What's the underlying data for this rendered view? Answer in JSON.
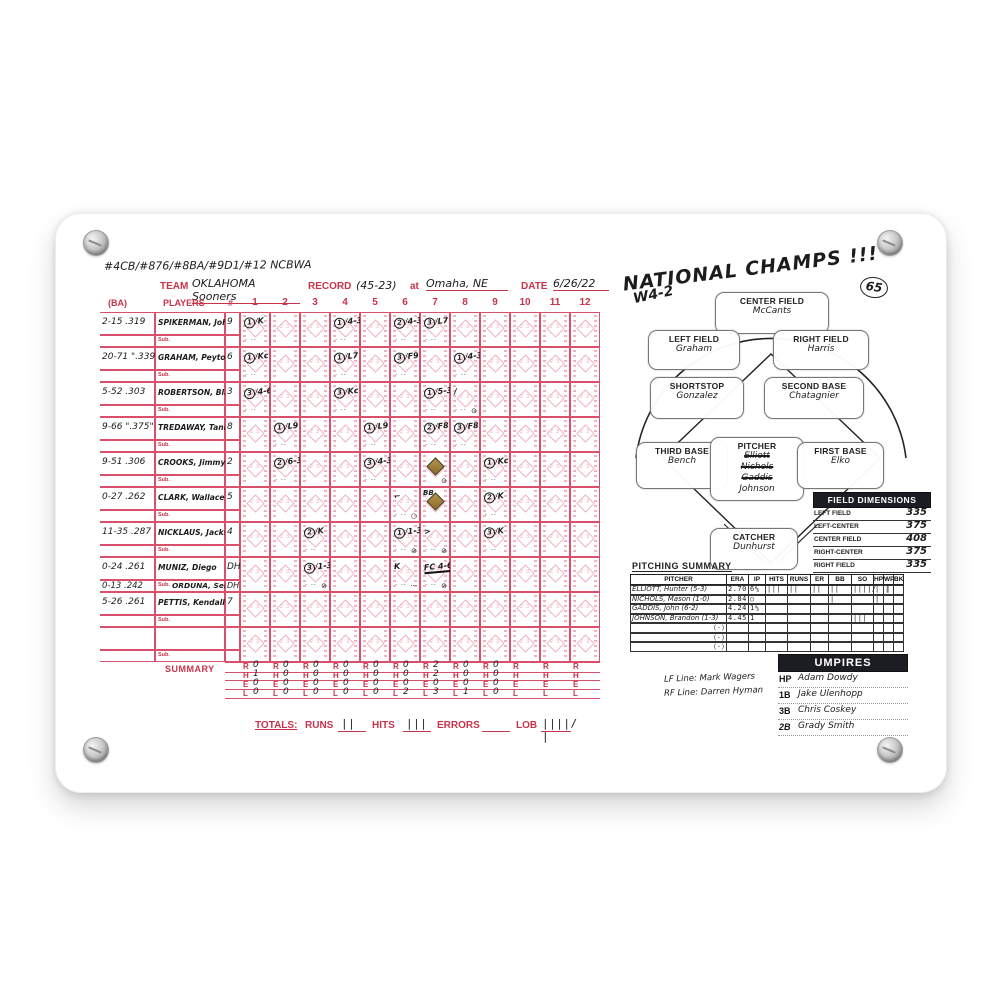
{
  "plaque": {
    "description": "white mounted scorecard plaque"
  },
  "scorecard": {
    "rankings_note": "#4CB/#876/#8BA/#9D1/#12 NCBWA",
    "header": {
      "team_label": "TEAM",
      "team": "OKLAHOMA Sooners",
      "record_label": "RECORD",
      "record": "(45-23)",
      "at_label": "at",
      "location": "Omaha, NE",
      "date_label": "DATE",
      "date": "6/26/22"
    },
    "grid": {
      "ba_label": "(BA)",
      "players_label": "PLAYERS",
      "pos_label": "#",
      "sub_label": "Sub.",
      "summary_label": "SUMMARY",
      "innings": [
        "1",
        "2",
        "3",
        "4",
        "5",
        "6",
        "7",
        "8",
        "9",
        "10",
        "11",
        "12"
      ],
      "players": [
        {
          "ba": "2-15 .319",
          "name": "SPIKERMAN, John",
          "pos": "9"
        },
        {
          "ba": "20-71 \".339\"",
          "name": "GRAHAM, Peyton",
          "pos": "6"
        },
        {
          "ba": "5-52 .303",
          "name": "ROBERTSON, Blake",
          "pos": "3"
        },
        {
          "ba": "9-66 \".375\"",
          "name": "TREDAWAY, Tanner",
          "pos": "8"
        },
        {
          "ba": "9-51 .306",
          "name": "CROOKS, Jimmy",
          "pos": "2"
        },
        {
          "ba": "0-27 .262",
          "name": "CLARK, Wallace",
          "pos": "5"
        },
        {
          "ba": "11-35 .287",
          "name": "NICKLAUS, Jackson",
          "pos": "4"
        },
        {
          "ba": "0-24 .261",
          "name": "MUNIZ, Diego",
          "pos": "DH",
          "sub": {
            "ba": "0-13 .242",
            "name": "ORDUNA, Sebast.",
            "pos": "DH"
          }
        },
        {
          "ba": "5-26 .261",
          "name": "PETTIS, Kendall",
          "pos": "7"
        },
        {
          "ba": "",
          "name": "",
          "pos": ""
        }
      ],
      "cells": [
        {
          "r": 0,
          "c": 0,
          "out": "1",
          "play": "K"
        },
        {
          "r": 0,
          "c": 3,
          "out": "1",
          "play": "4-3"
        },
        {
          "r": 0,
          "c": 5,
          "out": "2",
          "play": "4-3"
        },
        {
          "r": 0,
          "c": 6,
          "out": "3",
          "play": "L7"
        },
        {
          "r": 1,
          "c": 0,
          "out": "1",
          "play": "Kc"
        },
        {
          "r": 1,
          "c": 3,
          "out": "1",
          "play": "L7"
        },
        {
          "r": 1,
          "c": 5,
          "out": "3",
          "play": "F9"
        },
        {
          "r": 1,
          "c": 7,
          "out": "1",
          "play": "4-3"
        },
        {
          "r": 2,
          "c": 0,
          "out": "3",
          "play": "4-6-3"
        },
        {
          "r": 2,
          "c": 3,
          "out": "3",
          "play": "Kc"
        },
        {
          "r": 2,
          "c": 6,
          "out": "1",
          "play": "5-3"
        },
        {
          "r": 2,
          "c": 7,
          "play": "/",
          "extra": "⊙"
        },
        {
          "r": 3,
          "c": 1,
          "out": "1",
          "play": "L9"
        },
        {
          "r": 3,
          "c": 4,
          "out": "1",
          "play": "L9"
        },
        {
          "r": 3,
          "c": 6,
          "out": "2",
          "play": "F8"
        },
        {
          "r": 3,
          "c": 7,
          "out": "3",
          "play": "F8"
        },
        {
          "r": 4,
          "c": 1,
          "out": "2",
          "play": "6-3"
        },
        {
          "r": 4,
          "c": 4,
          "out": "3",
          "play": "4-3"
        },
        {
          "r": 4,
          "c": 6,
          "diamond": true,
          "extra": "⊙"
        },
        {
          "r": 4,
          "c": 8,
          "out": "1",
          "play": "Kc"
        },
        {
          "r": 5,
          "c": 5,
          "play": "⌐",
          "extra": "○"
        },
        {
          "r": 5,
          "c": 6,
          "diamond": true,
          "play": "BB"
        },
        {
          "r": 5,
          "c": 8,
          "out": "2",
          "play": "K"
        },
        {
          "r": 6,
          "c": 2,
          "out": "2",
          "play": "K"
        },
        {
          "r": 6,
          "c": 5,
          "out": "1",
          "play": "1-3",
          "extra": "⊘"
        },
        {
          "r": 6,
          "c": 6,
          "play": ">",
          "extra": "⊘"
        },
        {
          "r": 6,
          "c": 8,
          "out": "3",
          "play": "K"
        },
        {
          "r": 7,
          "c": 2,
          "out": "3",
          "play": "1-3",
          "extra": "⊘"
        },
        {
          "r": 7,
          "c": 5,
          "play": "K",
          "extra": "···"
        },
        {
          "r": 7,
          "c": 6,
          "play": "FC 4-6",
          "ul": true,
          "extra": "⊘"
        }
      ],
      "summary_rows": [
        {
          "label": "R",
          "values": [
            "0",
            "0",
            "0",
            "0",
            "0",
            "0",
            "2",
            "0",
            "0",
            "",
            "",
            ""
          ]
        },
        {
          "label": "H",
          "values": [
            "1",
            "0",
            "0",
            "0",
            "0",
            "0",
            "2",
            "0",
            "0",
            "",
            "",
            ""
          ]
        },
        {
          "label": "E",
          "values": [
            "0",
            "0",
            "0",
            "0",
            "0",
            "0",
            "0",
            "0",
            "0",
            "",
            "",
            ""
          ]
        },
        {
          "label": "L",
          "values": [
            "0",
            "0",
            "0",
            "0",
            "0",
            "2",
            "3",
            "1",
            "0",
            "",
            "",
            ""
          ]
        }
      ]
    },
    "totals": {
      "label": "TOTALS:",
      "runs_label": "RUNS",
      "runs": "||",
      "hits_label": "HITS",
      "hits": "|||",
      "errors_label": "ERRORS",
      "errors": "",
      "lob_label": "LOB",
      "lob": "||||/ |"
    },
    "champs_note": {
      "line1": "NATIONAL CHAMPS !!!",
      "line2": "W4-2",
      "circled": "65"
    },
    "field": {
      "positions": [
        {
          "key": "cf",
          "label": "CENTER FIELD",
          "names": [
            {
              "n": "McCants"
            }
          ]
        },
        {
          "key": "lf",
          "label": "LEFT FIELD",
          "names": [
            {
              "n": "Graham"
            }
          ]
        },
        {
          "key": "rf",
          "label": "RIGHT FIELD",
          "names": [
            {
              "n": "Harris"
            }
          ]
        },
        {
          "key": "ss",
          "label": "SHORTSTOP",
          "names": [
            {
              "n": "Gonzalez"
            }
          ]
        },
        {
          "key": "b2",
          "label": "SECOND BASE",
          "names": [
            {
              "n": "Chatagnier"
            }
          ]
        },
        {
          "key": "b3",
          "label": "THIRD BASE",
          "names": [
            {
              "n": "Bench"
            }
          ]
        },
        {
          "key": "p",
          "label": "PITCHER",
          "names": [
            {
              "n": "Elliott",
              "crossed": true
            },
            {
              "n": "Nichols",
              "crossed": true
            },
            {
              "n": "Gaddis",
              "crossed": true
            },
            {
              "n": "Johnson"
            }
          ]
        },
        {
          "key": "b1",
          "label": "FIRST BASE",
          "names": [
            {
              "n": "Elko"
            }
          ]
        },
        {
          "key": "c",
          "label": "CATCHER",
          "names": [
            {
              "n": "Dunhurst"
            }
          ]
        }
      ]
    },
    "dimensions": {
      "title": "FIELD DIMENSIONS",
      "rows": [
        {
          "label": "LEFT FIELD",
          "value": "335"
        },
        {
          "label": "LEFT-CENTER",
          "value": "375"
        },
        {
          "label": "CENTER FIELD",
          "value": "408"
        },
        {
          "label": "RIGHT-CENTER",
          "value": "375"
        },
        {
          "label": "RIGHT FIELD",
          "value": "335"
        }
      ]
    },
    "pitching": {
      "title": "PITCHING SUMMARY",
      "headers": [
        "PITCHER",
        "ERA",
        "IP",
        "HITS",
        "RUNS",
        "ER",
        "BB",
        "SO",
        "HP",
        "WP",
        "BK"
      ],
      "rows": [
        {
          "name": "ELLIOTT, Hunter",
          "rec": "(5-3)",
          "era": "2.70",
          "ip": "6⅔",
          "hits": "|||",
          "runs": "||",
          "er": "||",
          "bb": "||",
          "so": "||||/ ||",
          "hp": "|",
          "wp": "|",
          "bk": ""
        },
        {
          "name": "NICHOLS, Mason",
          "rec": "(1-0)",
          "era": "2.84",
          "ip": "○",
          "hits": "",
          "runs": "",
          "er": "",
          "bb": "|",
          "so": "",
          "hp": "|",
          "wp": "",
          "bk": ""
        },
        {
          "name": "GADDIS, John",
          "rec": "(6-2)",
          "era": "4.24",
          "ip": "1⅓",
          "hits": "",
          "runs": "",
          "er": "",
          "bb": "",
          "so": "",
          "hp": "",
          "wp": "",
          "bk": ""
        },
        {
          "name": "JOHNSON, Brandon",
          "rec": "(1-3)",
          "era": "4.45",
          "ip": "1",
          "hits": "",
          "runs": "",
          "er": "",
          "bb": "",
          "so": "|||",
          "hp": "",
          "wp": "",
          "bk": ""
        },
        {
          "name": "",
          "rec": "( - )",
          "era": "",
          "ip": "",
          "hits": "",
          "runs": "",
          "er": "",
          "bb": "",
          "so": "",
          "hp": "",
          "wp": "",
          "bk": ""
        },
        {
          "name": "",
          "rec": "( - )",
          "era": "",
          "ip": "",
          "hits": "",
          "runs": "",
          "er": "",
          "bb": "",
          "so": "",
          "hp": "",
          "wp": "",
          "bk": ""
        },
        {
          "name": "",
          "rec": "( - )",
          "era": "",
          "ip": "",
          "hits": "",
          "runs": "",
          "er": "",
          "bb": "",
          "so": "",
          "hp": "",
          "wp": "",
          "bk": ""
        }
      ]
    },
    "umpires": {
      "title": "UMPIRES",
      "rows": [
        {
          "pos": "HP",
          "name": "Adam Dowdy"
        },
        {
          "pos": "1B",
          "name": "Jake Ulenhopp"
        },
        {
          "pos": "3B",
          "name": "Chris Coskey"
        },
        {
          "pos": "2B",
          "name": "Grady Smith"
        }
      ],
      "side_notes": [
        "LF Line: Mark Wagers",
        "RF Line: Darren Hyman"
      ]
    }
  }
}
